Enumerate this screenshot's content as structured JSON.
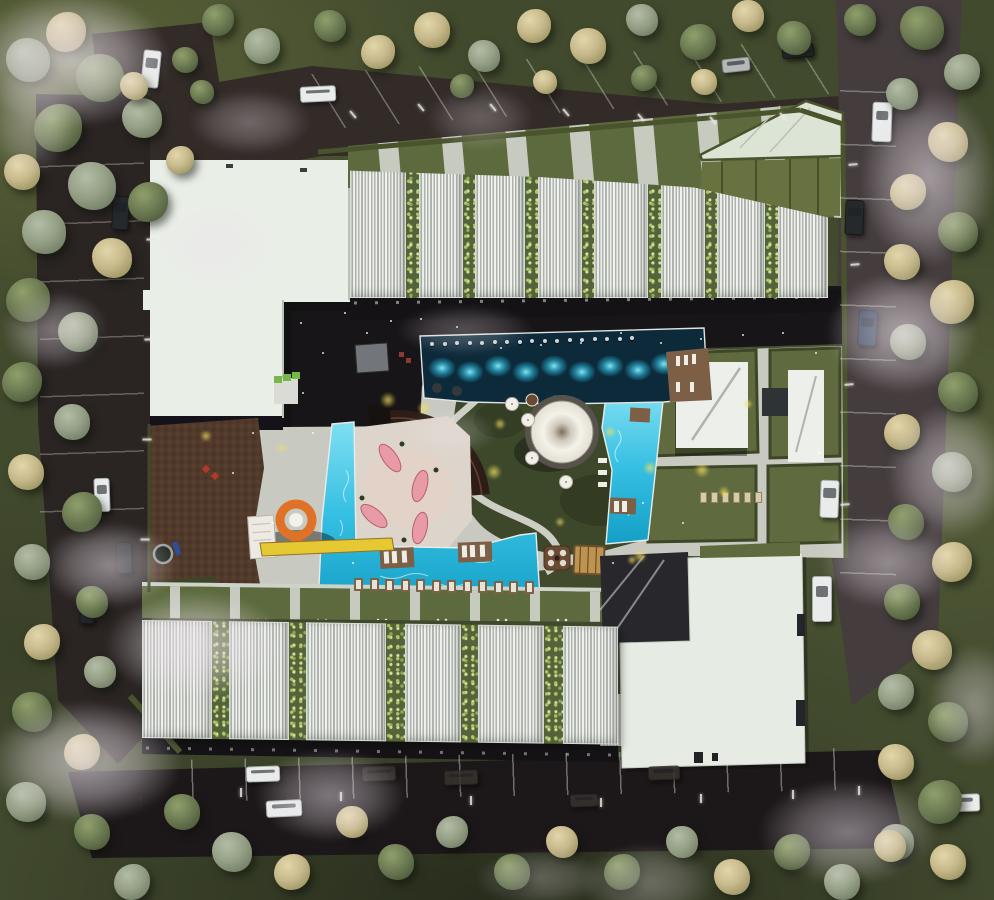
{
  "meta": {
    "description": "Aerial architectural render: residential complex with courtyard pools, water slide, amphitheater and canopy pavilion",
    "canvas_w": 994,
    "canvas_h": 900
  },
  "palette": {
    "road": "#2b2524",
    "road_dark": "#1c1719",
    "road_foggy": "#443c3d",
    "grass_dark": "#424a2e",
    "lawn": "#66713f",
    "hedge": "#49532c",
    "pavement": "#c8cac2",
    "plaza_brown": "#4c3628",
    "roof_white": "#e9efe7",
    "roof_mint": "#dce4d5",
    "facade_dark": "#141215",
    "pool_dark": "#0d2a3a",
    "pool_bright": "#35bfe2",
    "pool_glow": "#8ff0fc",
    "deck_brown": "#7d5f45",
    "tent_white": "#f4f2ea",
    "lounger_pink": "#e89ba6",
    "slide_orange": "#df7226",
    "slide_yellow": "#e6c832",
    "glow_yellow": "#f2de5c",
    "fog": "#ece3ea",
    "tree_green": "#6e7c54",
    "tree_sage": "#96a086",
    "tree_tan": "#c7b98b"
  },
  "north_wing": {
    "panels": [
      {
        "t": "l",
        "w": 56
      },
      {
        "t": "p",
        "w": 13
      },
      {
        "t": "l",
        "w": 44
      },
      {
        "t": "p",
        "w": 12
      },
      {
        "t": "l",
        "w": 50
      },
      {
        "t": "p",
        "w": 13
      },
      {
        "t": "l",
        "w": 44
      },
      {
        "t": "p",
        "w": 12
      },
      {
        "t": "l",
        "w": 54
      },
      {
        "t": "p",
        "w": 13
      },
      {
        "t": "l",
        "w": 44
      },
      {
        "t": "p",
        "w": 12
      },
      {
        "t": "l",
        "w": 48
      },
      {
        "t": "p",
        "w": 13
      },
      {
        "t": "l",
        "w": 50
      }
    ]
  },
  "south_wing": {
    "panels": [
      {
        "t": "l",
        "w": 70
      },
      {
        "t": "p",
        "w": 17
      },
      {
        "t": "l",
        "w": 60
      },
      {
        "t": "p",
        "w": 17
      },
      {
        "t": "l",
        "w": 80
      },
      {
        "t": "p",
        "w": 19
      },
      {
        "t": "l",
        "w": 56
      },
      {
        "t": "p",
        "w": 17
      },
      {
        "t": "l",
        "w": 66
      },
      {
        "t": "p",
        "w": 19
      },
      {
        "t": "l",
        "w": 55
      }
    ]
  },
  "trees": [
    [
      28,
      60,
      22,
      "s"
    ],
    [
      66,
      32,
      20,
      "t"
    ],
    [
      100,
      78,
      24,
      "g"
    ],
    [
      142,
      118,
      20,
      "s"
    ],
    [
      58,
      128,
      24,
      "g"
    ],
    [
      22,
      172,
      18,
      "t"
    ],
    [
      92,
      186,
      24,
      "s"
    ],
    [
      148,
      202,
      20,
      "g"
    ],
    [
      44,
      232,
      22,
      "s"
    ],
    [
      112,
      258,
      20,
      "t"
    ],
    [
      28,
      300,
      22,
      "g"
    ],
    [
      78,
      332,
      20,
      "s"
    ],
    [
      134,
      86,
      14,
      "t"
    ],
    [
      180,
      160,
      14,
      "t"
    ],
    [
      185,
      60,
      13,
      "g"
    ],
    [
      202,
      92,
      12,
      "g"
    ],
    [
      218,
      20,
      16,
      "g"
    ],
    [
      262,
      46,
      18,
      "s"
    ],
    [
      330,
      26,
      16,
      "g"
    ],
    [
      378,
      52,
      17,
      "t"
    ],
    [
      432,
      30,
      18,
      "t"
    ],
    [
      484,
      56,
      16,
      "s"
    ],
    [
      534,
      26,
      17,
      "t"
    ],
    [
      588,
      46,
      18,
      "t"
    ],
    [
      642,
      20,
      16,
      "s"
    ],
    [
      698,
      42,
      18,
      "g"
    ],
    [
      748,
      16,
      16,
      "t"
    ],
    [
      794,
      38,
      17,
      "g"
    ],
    [
      644,
      78,
      13,
      "g"
    ],
    [
      704,
      82,
      13,
      "t"
    ],
    [
      545,
      82,
      12,
      "t"
    ],
    [
      462,
      86,
      12,
      "g"
    ],
    [
      860,
      20,
      16,
      "g"
    ],
    [
      922,
      28,
      22,
      "g"
    ],
    [
      962,
      72,
      18,
      "s"
    ],
    [
      902,
      94,
      16,
      "s"
    ],
    [
      948,
      142,
      20,
      "t"
    ],
    [
      908,
      192,
      18,
      "t"
    ],
    [
      958,
      232,
      20,
      "g"
    ],
    [
      902,
      262,
      18,
      "t"
    ],
    [
      952,
      302,
      22,
      "t"
    ],
    [
      908,
      342,
      18,
      "s"
    ],
    [
      958,
      392,
      20,
      "g"
    ],
    [
      902,
      432,
      18,
      "t"
    ],
    [
      952,
      472,
      20,
      "s"
    ],
    [
      906,
      522,
      18,
      "g"
    ],
    [
      952,
      562,
      20,
      "t"
    ],
    [
      902,
      602,
      18,
      "g"
    ],
    [
      932,
      650,
      20,
      "t"
    ],
    [
      896,
      692,
      18,
      "s"
    ],
    [
      948,
      722,
      20,
      "g"
    ],
    [
      896,
      762,
      18,
      "t"
    ],
    [
      940,
      802,
      22,
      "g"
    ],
    [
      896,
      842,
      18,
      "s"
    ],
    [
      948,
      862,
      18,
      "t"
    ],
    [
      22,
      382,
      20,
      "g"
    ],
    [
      72,
      422,
      18,
      "s"
    ],
    [
      26,
      472,
      18,
      "t"
    ],
    [
      82,
      512,
      20,
      "g"
    ],
    [
      32,
      562,
      18,
      "s"
    ],
    [
      92,
      602,
      16,
      "g"
    ],
    [
      42,
      642,
      18,
      "t"
    ],
    [
      100,
      672,
      16,
      "s"
    ],
    [
      32,
      712,
      20,
      "g"
    ],
    [
      82,
      752,
      18,
      "t"
    ],
    [
      26,
      802,
      20,
      "s"
    ],
    [
      92,
      832,
      18,
      "g"
    ],
    [
      132,
      882,
      18,
      "s"
    ],
    [
      182,
      812,
      18,
      "g"
    ],
    [
      232,
      852,
      20,
      "s"
    ],
    [
      292,
      872,
      18,
      "t"
    ],
    [
      352,
      822,
      16,
      "t"
    ],
    [
      396,
      862,
      18,
      "g"
    ],
    [
      452,
      832,
      16,
      "s"
    ],
    [
      512,
      872,
      18,
      "g"
    ],
    [
      562,
      842,
      16,
      "t"
    ],
    [
      622,
      872,
      18,
      "g"
    ],
    [
      682,
      842,
      16,
      "s"
    ],
    [
      732,
      877,
      18,
      "t"
    ],
    [
      792,
      852,
      18,
      "g"
    ],
    [
      842,
      882,
      18,
      "s"
    ],
    [
      890,
      846,
      16,
      "t"
    ]
  ],
  "fog": [
    [
      70,
      60,
      140,
      95,
      0.75
    ],
    [
      215,
      245,
      95,
      65,
      0.5
    ],
    [
      55,
      330,
      75,
      55,
      0.45
    ],
    [
      110,
      565,
      95,
      60,
      0.55
    ],
    [
      195,
      645,
      125,
      75,
      0.65
    ],
    [
      85,
      762,
      135,
      85,
      0.7
    ],
    [
      330,
      795,
      105,
      65,
      0.5
    ],
    [
      480,
      118,
      75,
      45,
      0.3
    ],
    [
      465,
      330,
      95,
      35,
      0.3
    ],
    [
      450,
      432,
      65,
      32,
      0.28
    ],
    [
      928,
      178,
      95,
      125,
      0.6
    ],
    [
      902,
      332,
      105,
      85,
      0.65
    ],
    [
      948,
      472,
      85,
      95,
      0.55
    ],
    [
      888,
      562,
      95,
      65,
      0.5
    ],
    [
      848,
      832,
      125,
      75,
      0.5
    ],
    [
      648,
      882,
      95,
      55,
      0.35
    ],
    [
      975,
      705,
      65,
      85,
      0.45
    ],
    [
      250,
      122,
      85,
      45,
      0.35
    ],
    [
      540,
      878,
      90,
      40,
      0.3
    ],
    [
      30,
      120,
      60,
      80,
      0.4
    ]
  ],
  "cars": [
    [
      142,
      50,
      16,
      36,
      6,
      "white"
    ],
    [
      112,
      196,
      15,
      32,
      3,
      "dark"
    ],
    [
      300,
      86,
      34,
      14,
      -3,
      "white"
    ],
    [
      722,
      58,
      26,
      12,
      -6,
      "gray"
    ],
    [
      782,
      44,
      30,
      12,
      -5,
      "dark"
    ],
    [
      872,
      102,
      18,
      38,
      2,
      "white"
    ],
    [
      845,
      200,
      17,
      33,
      2,
      "dark"
    ],
    [
      858,
      310,
      17,
      34,
      3,
      "blue"
    ],
    [
      820,
      480,
      17,
      36,
      2,
      "white"
    ],
    [
      812,
      576,
      18,
      44,
      0,
      "white"
    ],
    [
      94,
      478,
      14,
      32,
      -2,
      "white"
    ],
    [
      116,
      542,
      14,
      30,
      -2,
      "dark"
    ],
    [
      246,
      766,
      32,
      14,
      -2,
      "white"
    ],
    [
      266,
      800,
      34,
      15,
      -3,
      "white"
    ],
    [
      362,
      766,
      32,
      13,
      -2,
      "ghost"
    ],
    [
      444,
      770,
      32,
      13,
      -2,
      "ghost"
    ],
    [
      570,
      794,
      26,
      11,
      -2,
      "ghost"
    ],
    [
      648,
      766,
      30,
      12,
      -2,
      "ghost"
    ],
    [
      938,
      794,
      40,
      16,
      -2,
      "white"
    ],
    [
      80,
      598,
      13,
      24,
      3,
      "dark"
    ]
  ],
  "lamps": [
    [
      352,
      110,
      -40
    ],
    [
      420,
      103,
      -40
    ],
    [
      492,
      103,
      -40
    ],
    [
      565,
      108,
      -40
    ],
    [
      640,
      113,
      -40
    ],
    [
      712,
      116,
      -40
    ],
    [
      782,
      112,
      -40
    ],
    [
      150,
      235,
      90
    ],
    [
      148,
      335,
      90
    ],
    [
      146,
      435,
      90
    ],
    [
      144,
      535,
      90
    ],
    [
      852,
      160,
      85
    ],
    [
      854,
      260,
      85
    ],
    [
      848,
      380,
      85
    ],
    [
      844,
      500,
      85
    ],
    [
      240,
      788,
      0
    ],
    [
      340,
      792,
      0
    ],
    [
      470,
      796,
      0
    ],
    [
      600,
      798,
      0
    ],
    [
      700,
      794,
      0
    ],
    [
      792,
      790,
      0
    ],
    [
      858,
      786,
      0
    ]
  ],
  "pool_stools": {
    "count": 17,
    "x0": 430,
    "y0": 342,
    "dx": 12.5,
    "dy": -0.35
  },
  "lounger_row": {
    "count": 12,
    "x0": 354,
    "y0": 578,
    "dx": 15.5,
    "dy": 0.3
  },
  "lawn_loungers": {
    "count": 6,
    "x0": 700,
    "y0": 492,
    "dx": 11,
    "dy": 0
  },
  "ground_lights": [
    [
      300,
      322
    ],
    [
      322,
      352
    ],
    [
      344,
      312
    ],
    [
      366,
      332
    ],
    [
      390,
      320
    ],
    [
      420,
      318
    ],
    [
      456,
      326
    ],
    [
      302,
      392
    ],
    [
      312,
      432
    ],
    [
      620,
      332
    ],
    [
      660,
      342
    ],
    [
      700,
      338
    ],
    [
      742,
      334
    ],
    [
      782,
      332
    ],
    [
      500,
      347
    ],
    [
      540,
      344
    ],
    [
      580,
      342
    ],
    [
      642,
      502
    ],
    [
      682,
      522
    ],
    [
      612,
      562
    ],
    [
      352,
      562
    ],
    [
      252,
      432
    ],
    [
      232,
      472
    ],
    [
      272,
      522
    ],
    [
      815,
      352
    ],
    [
      818,
      452
    ]
  ],
  "glows": [
    [
      388,
      400,
      8
    ],
    [
      424,
      408,
      7
    ],
    [
      500,
      424,
      6
    ],
    [
      494,
      472,
      8
    ],
    [
      610,
      432,
      6
    ],
    [
      650,
      468,
      7
    ],
    [
      702,
      470,
      8
    ],
    [
      724,
      492,
      6
    ],
    [
      560,
      522,
      5
    ],
    [
      640,
      556,
      7
    ],
    [
      206,
      436,
      6
    ],
    [
      748,
      404,
      5
    ],
    [
      282,
      448,
      5
    ],
    [
      632,
      560,
      5
    ]
  ]
}
